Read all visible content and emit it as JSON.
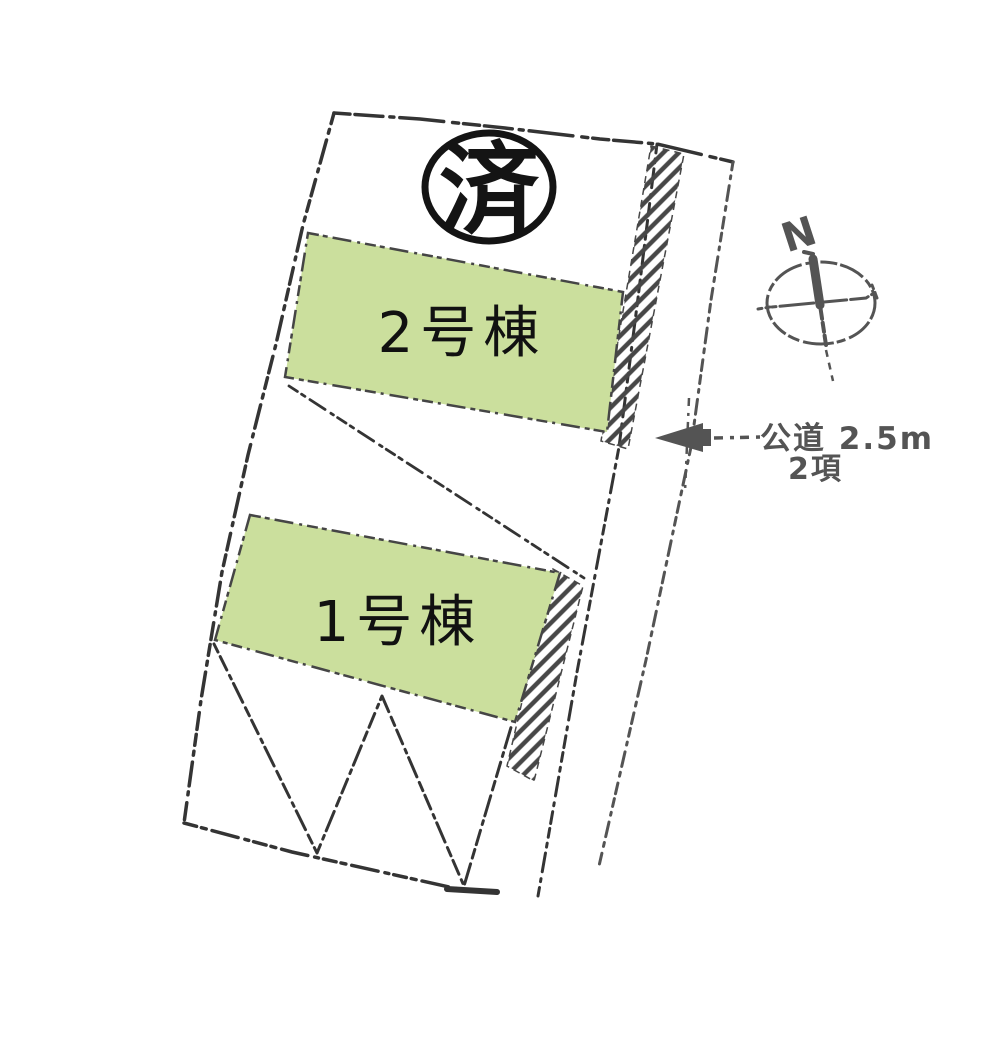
{
  "drawing": {
    "title": "site-plan",
    "stamp": {
      "label": "済"
    },
    "parcels": [
      {
        "label": "2号棟"
      },
      {
        "label": "1号棟"
      }
    ],
    "compass": {
      "north_label": "N"
    },
    "road_annotation": {
      "line1": "公道 2.5m",
      "line2": "2項"
    }
  },
  "colors": {
    "background": "#ffffff",
    "parcel_fill": "#cbdf9d",
    "parcel_edge": "#454545",
    "outline_dark": "#343434",
    "sketch_gray": "#545454",
    "stamp_black": "#141414",
    "label_black": "#111111"
  }
}
